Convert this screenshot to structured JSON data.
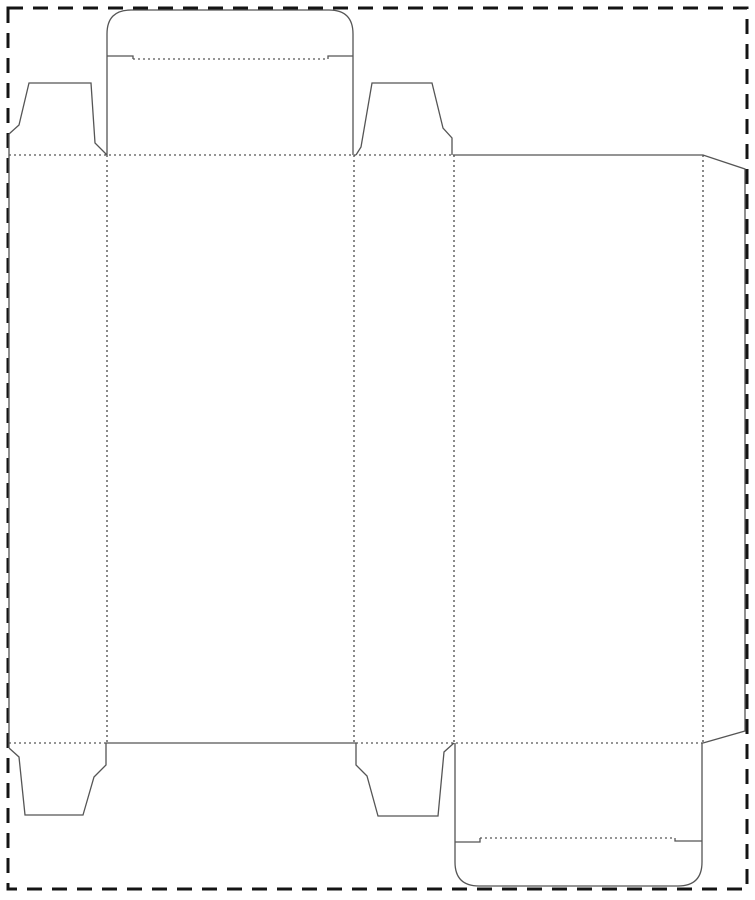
{
  "canvas": {
    "width": 755,
    "height": 900,
    "background": "#ffffff",
    "description": "Reverse tuck-end carton dieline template with cut lines, fold lines and dashed trim border"
  },
  "trim_border": {
    "x": 8,
    "y": 8,
    "width": 739,
    "height": 881,
    "color": "#141414",
    "stroke_width": 3,
    "dash": "15 10"
  },
  "styles": {
    "cut": {
      "color": "#555555",
      "stroke_width": 1.3,
      "dash": ""
    },
    "fold": {
      "color": "#2b2b2b",
      "stroke_width": 1.1,
      "dash": "2 3"
    }
  },
  "cut_paths": [
    {
      "name": "top-tuck-flap-outline",
      "d": "M 107,155 L 107,34 Q 107,10 131,10 L 329,10 Q 353,10 353,34 L 353,155"
    },
    {
      "name": "top-tuck-left-shoulder",
      "d": "M 107,56 L 133,56 L 133,59"
    },
    {
      "name": "top-tuck-right-shoulder",
      "d": "M 353,56 L 328,56 L 328,59"
    },
    {
      "name": "top-left-dust-flap",
      "d": "M 9,134 L 19,125 L 29,83 L 91,83 L 95,143 L 107,155"
    },
    {
      "name": "left-panel-edge",
      "d": "M 9,134 L 9,748"
    },
    {
      "name": "top-right-dust-flap",
      "d": "M 356,155 L 361,147 L 372,83 L 432,83 L 443,128 L 452,138 L 452,155"
    },
    {
      "name": "back-panel-top-and-glue-flap",
      "d": "M 453,155 L 703,155 L 745,169 L 745,731 L 703,743"
    },
    {
      "name": "front-panel-bottom-edge",
      "d": "M 106,743 L 356,743"
    },
    {
      "name": "bottom-left-dust-flap",
      "d": "M 9,748 L 19,757 L 25,815 L 83,815 L 94,777 L 106,765 L 106,743"
    },
    {
      "name": "bottom-middle-dust-flap",
      "d": "M 356,743 L 356,765 L 367,776 L 378,816 L 438,816 L 444,752 L 454,743"
    },
    {
      "name": "bottom-tuck-flap-outline",
      "d": "M 455,743 L 455,862 Q 455,886 479,886 L 678,886 Q 702,886 702,862 L 702,743"
    },
    {
      "name": "bottom-tuck-left-shoulder",
      "d": "M 455,842 L 480,842 L 480,838"
    },
    {
      "name": "bottom-tuck-right-shoulder",
      "d": "M 702,841 L 675,841 L 675,838"
    }
  ],
  "fold_paths": [
    {
      "name": "top-tuck-fold",
      "d": "M 133,59 L 328,59"
    },
    {
      "name": "top-horizontal-fold",
      "d": "M 9,155 L 453,155"
    },
    {
      "name": "vertical-fold-left",
      "d": "M 107,155 L 107,743"
    },
    {
      "name": "vertical-fold-middle",
      "d": "M 354,155 L 354,743"
    },
    {
      "name": "vertical-fold-right",
      "d": "M 454,155 L 454,743"
    },
    {
      "name": "glue-flap-fold",
      "d": "M 703,155 L 703,743"
    },
    {
      "name": "bottom-left-fold",
      "d": "M 9,743 L 106,743"
    },
    {
      "name": "bottom-horizontal-fold",
      "d": "M 356,743 L 703,743"
    },
    {
      "name": "bottom-tuck-fold",
      "d": "M 480,838 L 675,838"
    }
  ]
}
